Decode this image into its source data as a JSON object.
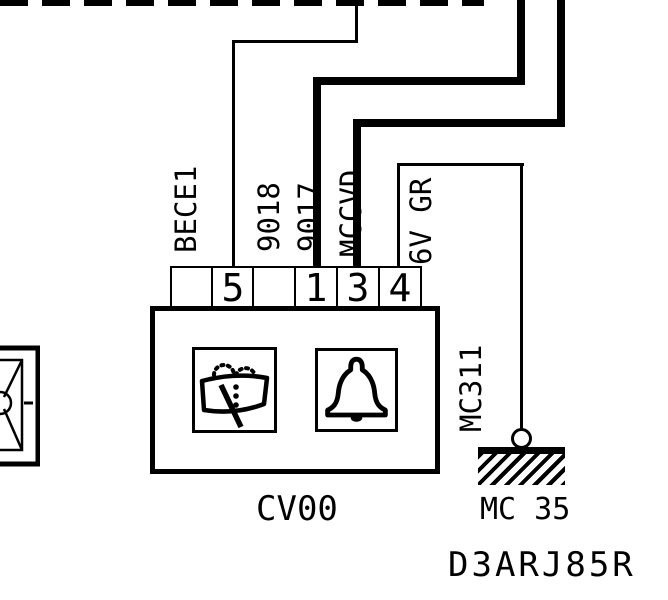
{
  "colors": {
    "ink": "#000000",
    "paper": "#ffffff"
  },
  "reference_code": "D3ARJ85R",
  "component": {
    "id": "CV00",
    "pins": [
      "",
      "5",
      "",
      "1",
      "3",
      "4"
    ],
    "function_icons": [
      "wiper-washer-icon",
      "bell-horn-icon"
    ]
  },
  "ground": {
    "id": "MC 35",
    "connection_label": "MC311"
  },
  "wires": {
    "bece1": {
      "label": "BECE1",
      "style": "thin"
    },
    "w9018": {
      "label": "9018",
      "style": "thick"
    },
    "w9017": {
      "label": "9017",
      "style": "thick"
    },
    "mccvd": {
      "label": "MCCVD",
      "style": "thin"
    },
    "gr6v": {
      "label": "6V GR",
      "style": "thin"
    },
    "nr4v": {
      "label": "4V NR",
      "style": "thin"
    }
  }
}
